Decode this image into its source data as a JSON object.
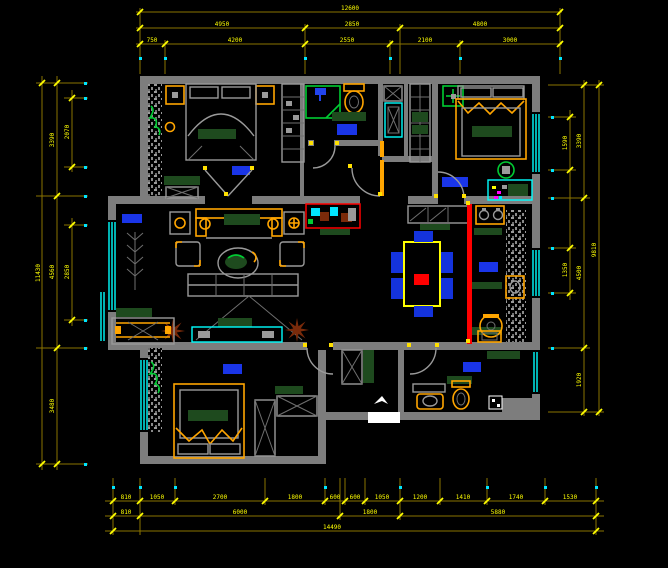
{
  "palette": {
    "wall": "#7d7d7d",
    "dim": "#8a7400",
    "yellow": "#ffff00",
    "window": "#00ffff",
    "accent": "#ffa500",
    "greenDark": "#1e4a1e",
    "greenBright": "#00cc33",
    "rugBlue": "#1a35e8",
    "red": "#ff0000",
    "brown": "#7a2a0a"
  },
  "dims": {
    "top": {
      "row1": [
        "12600"
      ],
      "row2": [
        "4950",
        "2850",
        "4800"
      ],
      "row3": [
        "750",
        "4200",
        "2550",
        "2100",
        "3000"
      ]
    },
    "bottom": {
      "row1": [
        "810",
        "1050",
        "2700",
        "1800",
        "600",
        "600",
        "1050",
        "1200",
        "1410",
        "1740",
        "1530"
      ],
      "row2": [
        "810",
        "6000",
        "1800",
        "5880"
      ],
      "row3": [
        "14490"
      ]
    },
    "left": {
      "outer": [
        "11430"
      ],
      "mid": [
        "3390",
        "4560",
        "3480"
      ],
      "inner": [
        "2070",
        "2850"
      ]
    },
    "right": {
      "outer": [
        "9810"
      ],
      "mid": [
        "3390",
        "4500",
        "1920"
      ],
      "inner": [
        "1590",
        "1350"
      ]
    }
  }
}
